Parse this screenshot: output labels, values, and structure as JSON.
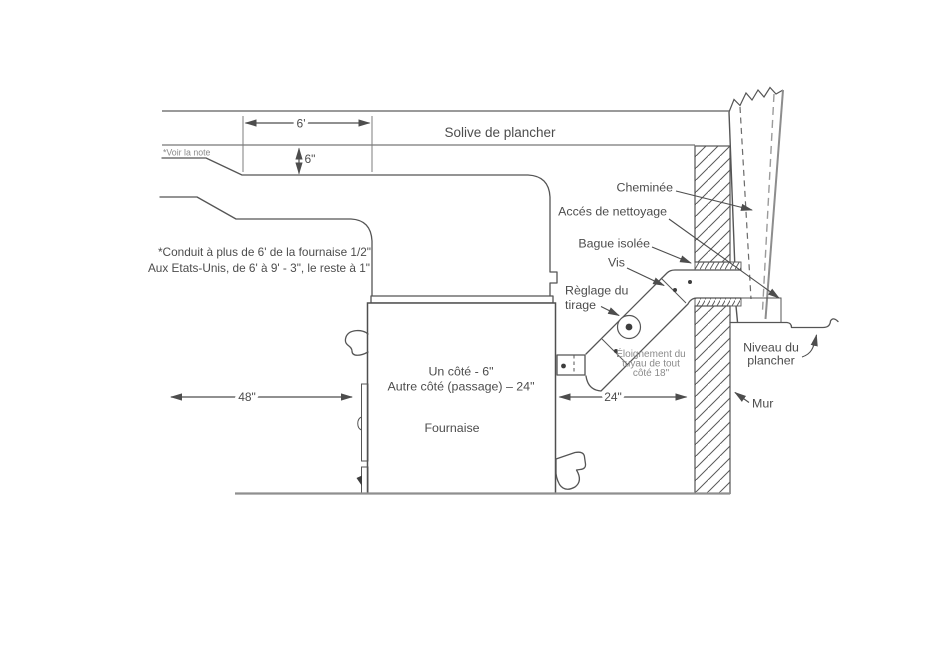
{
  "colors": {
    "background": "#ffffff",
    "line": "#555555",
    "line_gray": "#8f8f8f",
    "text": "#4d4d4d",
    "text_light": "#8b8b8b"
  },
  "ceiling": {
    "joist_label": "Solive de plancher",
    "note_ref": "*Voir la note"
  },
  "dimensions": {
    "duct_run": "6'",
    "duct_clearance": "6\"",
    "left_clearance": "48\"",
    "right_clearance": "24\""
  },
  "labels": {
    "chimney": "Cheminée",
    "cleaning_access": "Accés de nettoyage",
    "insulated_ring": "Bague isolée",
    "screw": "Vis",
    "damper_line1": "Règlage du",
    "damper_line2": "tirage",
    "pipe_clearance_line1": "Éloignement du",
    "pipe_clearance_line2": "tuyau de tout",
    "pipe_clearance_line3": "côté 18\"",
    "floor_level_line1": "Niveau du",
    "floor_level_line2": "plancher",
    "wall": "Mur"
  },
  "furnace": {
    "clearance_line1": "Un côté - 6\"",
    "clearance_line2": "Autre côté (passage) – 24\"",
    "name": "Fournaise"
  },
  "note": {
    "line1": "*Conduit à plus de 6' de la fournaise 1/2\"",
    "line2": "Aux Etats-Unis, de 6' à 9' - 3\", le reste à 1\""
  }
}
